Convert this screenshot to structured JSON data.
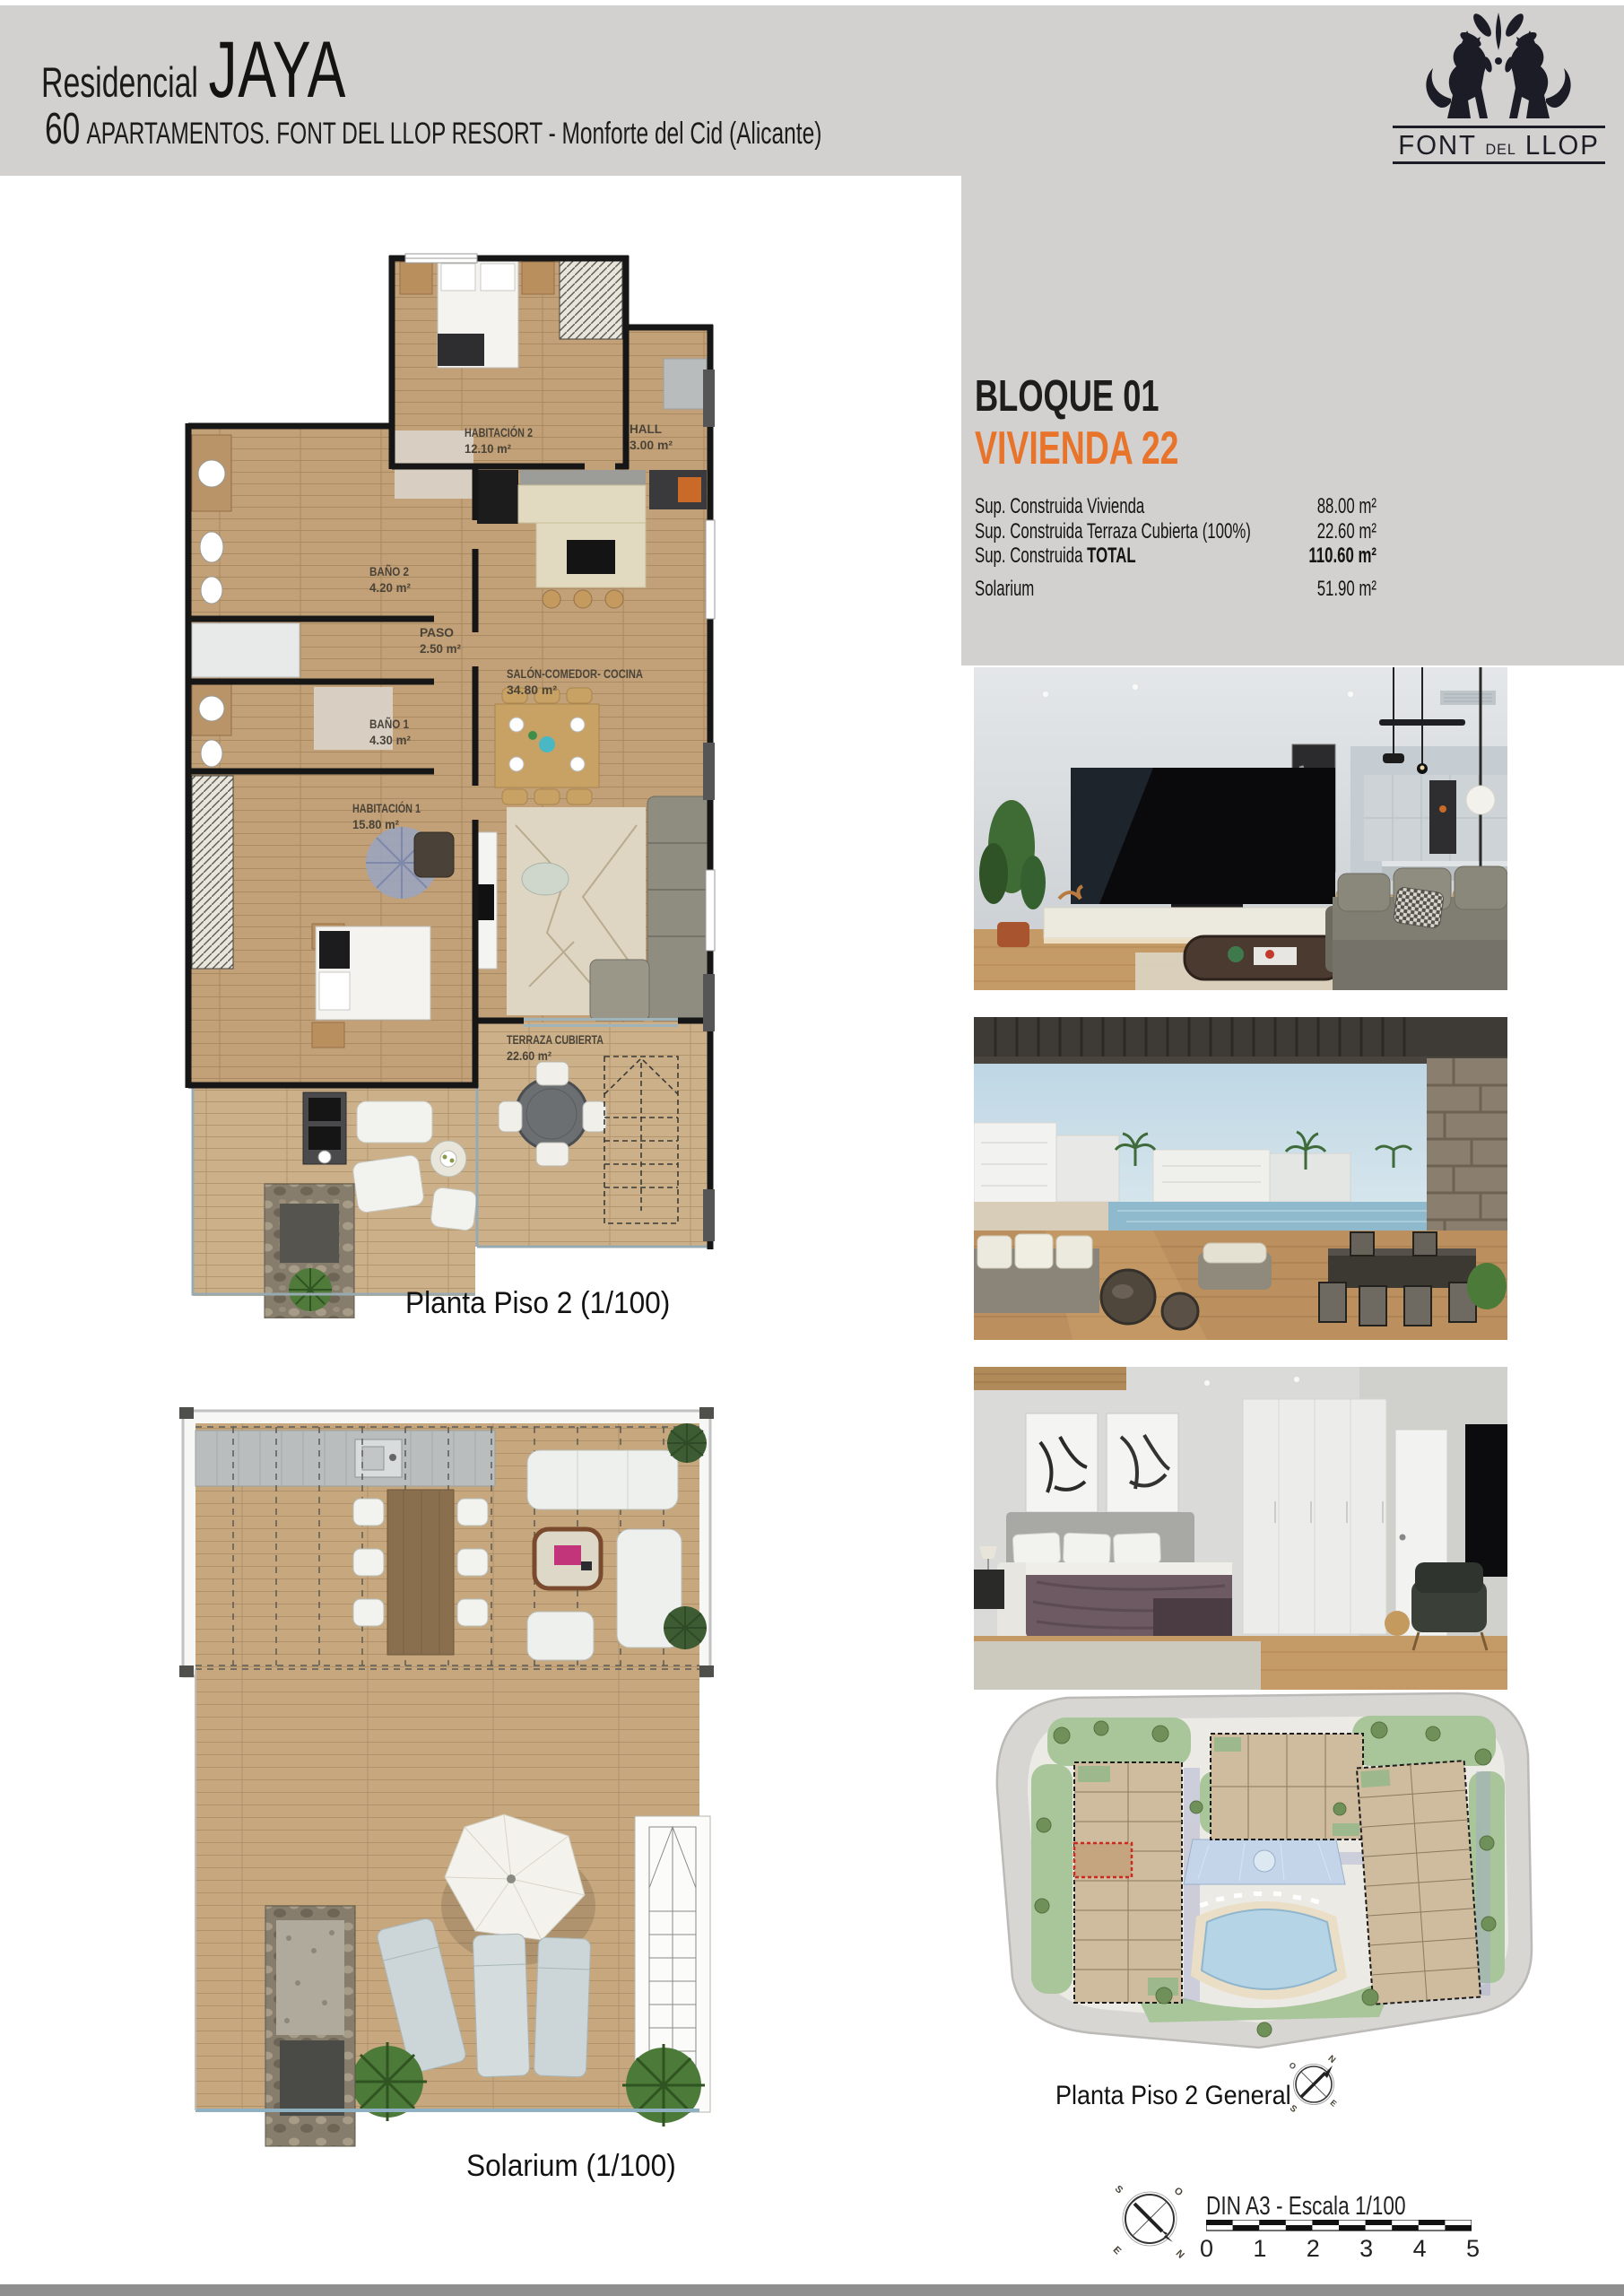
{
  "header": {
    "title_prefix": "Residencial",
    "title_name": "JAYA",
    "subtitle_number": "60",
    "subtitle_rest": "APARTAMENTOS. FONT DEL LLOP RESORT - Monforte del Cid (Alicante)"
  },
  "logo": {
    "font": "FONT",
    "del": "DEL",
    "llop": "LLOP"
  },
  "unit": {
    "block": "BLOQUE 01",
    "dwelling": "VIVIENDA 22",
    "accent_color": "#e8732a",
    "areas": [
      {
        "label": "Sup. Construida Vivienda",
        "value": "88.00 m²"
      },
      {
        "label": "Sup. Construida Terraza Cubierta (100%)",
        "value": "22.60 m²"
      },
      {
        "label_prefix": "Sup. Construida ",
        "label_bold": "TOTAL",
        "value": "110.60 m²"
      },
      {
        "label": "Solarium",
        "value": "51.90 m²"
      }
    ]
  },
  "plan_piso2": {
    "caption": "Planta Piso 2 (1/100)",
    "rooms": {
      "hab2": {
        "name": "HABITACIÓN 2",
        "area": "12.10 m²"
      },
      "hall": {
        "name": "HALL",
        "area": "3.00 m²"
      },
      "bano2": {
        "name": "BAÑO 2",
        "area": "4.20 m²"
      },
      "paso": {
        "name": "PASO",
        "area": "2.50 m²"
      },
      "bano1": {
        "name": "BAÑO 1",
        "area": "4.30 m²"
      },
      "hab1": {
        "name": "HABITACIÓN 1",
        "area": "15.80 m²"
      },
      "salon": {
        "name": "SALÓN-COMEDOR- COCINA",
        "area": "34.80 m²"
      },
      "terraza": {
        "name": "TERRAZA CUBIERTA",
        "area": "22.60 m²"
      }
    }
  },
  "plan_solarium": {
    "caption": "Solarium (1/100)",
    "room": {
      "name": "SOLARIUM",
      "area": "51.90 m²"
    }
  },
  "siteplan": {
    "caption": "Planta Piso 2 General"
  },
  "scalebar": {
    "label": "DIN A3 - Escala 1/100",
    "ticks": [
      "0",
      "1",
      "2",
      "3",
      "4",
      "5"
    ]
  },
  "compass": {
    "n": "N",
    "s": "S",
    "e": "E",
    "o": "O"
  }
}
